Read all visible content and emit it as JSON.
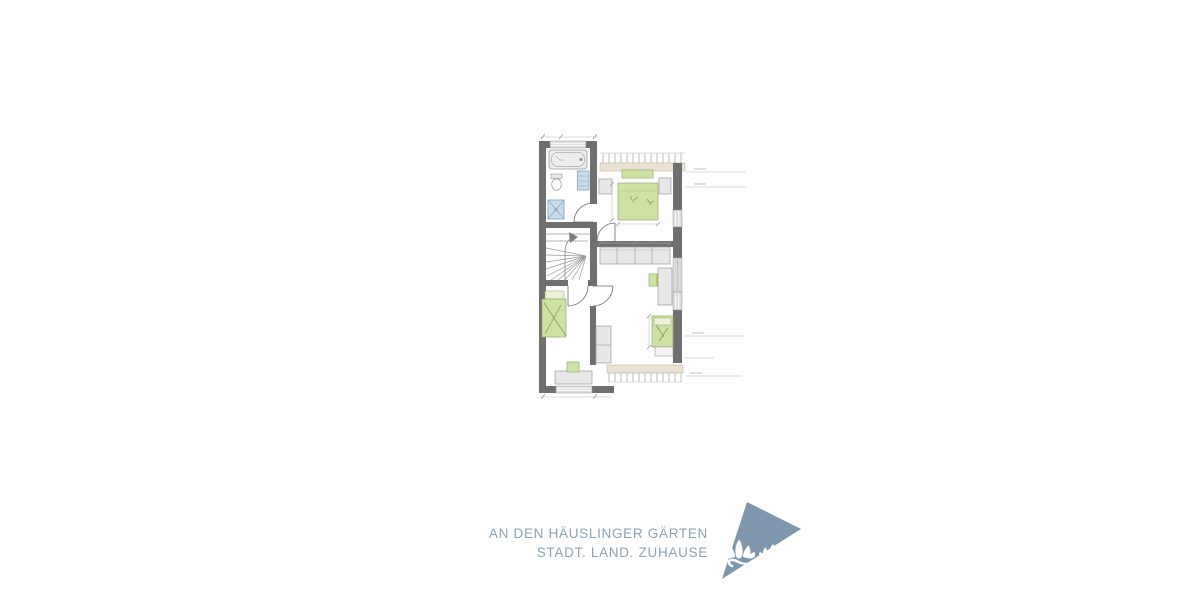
{
  "branding": {
    "line1": "AN DEN HÄUSLINGER GÄRTEN",
    "line2": "STADT. LAND. ZUHAUSE"
  },
  "floor_plan": {
    "type": "residential upper-floor plan (no text labels visible)",
    "elements": [
      "bathtub",
      "toilet",
      "towel-radiator",
      "shower",
      "winder-staircase",
      "walk-line-arrow",
      "double-bed",
      "nightstand-left",
      "nightstand-right",
      "hall-wardrobe",
      "closet",
      "single-bed-left",
      "single-bed-right",
      "desk-left",
      "desk-right",
      "chair-left",
      "chair-right",
      "door-swing-bath",
      "door-swing-bedroom",
      "door-swing-room-left",
      "door-swing-room-right",
      "window-top",
      "window-bottom",
      "windows-right-wall",
      "roof-edge-hatch-band-top",
      "roof-edge-hatch-band-bottom",
      "dimension-leader-lines"
    ]
  },
  "colors": {
    "wall": "#6f6f6f",
    "window_fill": "#dcdcdc",
    "furniture_fill": "#e7e7e7",
    "furniture_line": "#9c9c9c",
    "bed_fill": "#cfe2a5",
    "bed_line": "#93ac62",
    "fixture_fill": "#ccdcea",
    "fixture_line": "#7fa3c2",
    "band_beige": "#e9e2d2",
    "hatch_line": "#a2a29a",
    "dim_line": "#9a9a9a",
    "logo_blue": "#7e97ad",
    "text_blue": "#8ba3b6"
  }
}
